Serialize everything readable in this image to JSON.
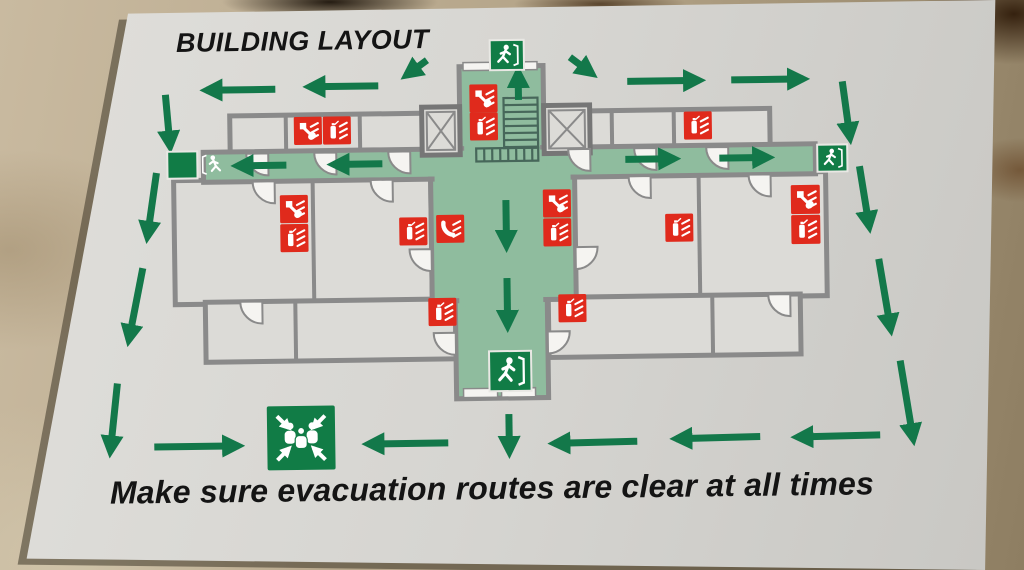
{
  "title": "BUILDING LAYOUT",
  "footer": "Make sure evacuation routes are clear at all times",
  "colors": {
    "floor": "#b4a489",
    "paper": "#d9d8d4",
    "wall": "#8a8a8a",
    "wall_dark": "#767676",
    "room": "#dcdbd7",
    "corridor": "#8fbc9e",
    "route_green": "#13784a",
    "sign_green": "#117c46",
    "alarm_red": "#e02a1c",
    "white": "#f5f4f1",
    "text": "#141414",
    "stairs": "#47675a"
  },
  "plan": {
    "rooms": [
      [
        232,
        112,
        196,
        38
      ],
      [
        550,
        112,
        222,
        38
      ],
      [
        175,
        176,
        257,
        124
      ],
      [
        575,
        176,
        252,
        124
      ],
      [
        205,
        298,
        250,
        60
      ],
      [
        548,
        298,
        252,
        60
      ]
    ],
    "inner_walls": [
      [
        288,
        112,
        288,
        150
      ],
      [
        362,
        112,
        362,
        150
      ],
      [
        614,
        112,
        614,
        150
      ],
      [
        676,
        112,
        676,
        150
      ],
      [
        314,
        176,
        314,
        300
      ],
      [
        700,
        176,
        700,
        300
      ],
      [
        295,
        298,
        295,
        358
      ],
      [
        712,
        298,
        712,
        358
      ]
    ],
    "corridors": [
      [
        462,
        66,
        84,
        112
      ],
      [
        205,
        148,
        612,
        30
      ],
      [
        432,
        178,
        144,
        122
      ],
      [
        455,
        300,
        92,
        98
      ]
    ],
    "patches": [
      [
        460,
        150,
        88,
        26
      ],
      [
        466,
        143,
        76,
        10
      ],
      [
        436,
        172,
        136,
        12
      ],
      [
        459,
        294,
        84,
        12
      ]
    ],
    "elevators": [
      [
        424,
        106,
        38,
        48
      ],
      [
        546,
        106,
        46,
        48
      ]
    ],
    "stairs": {
      "ladder": [
        506,
        98,
        34,
        50
      ],
      "run": [
        478,
        148,
        62,
        13
      ]
    },
    "doors": [
      [
        270,
        150,
        90
      ],
      [
        338,
        150,
        90
      ],
      [
        412,
        150,
        90
      ],
      [
        592,
        150,
        90
      ],
      [
        658,
        150,
        90
      ],
      [
        730,
        150,
        90
      ],
      [
        276,
        178,
        90
      ],
      [
        394,
        178,
        90
      ],
      [
        652,
        178,
        90
      ],
      [
        772,
        178,
        90
      ],
      [
        432,
        248,
        90
      ],
      [
        576,
        248,
        0
      ],
      [
        455,
        332,
        90
      ],
      [
        547,
        332,
        0
      ],
      [
        262,
        298,
        90
      ],
      [
        790,
        298,
        90
      ]
    ],
    "door_leafs": [
      [
        466,
        62,
        32,
        8
      ],
      [
        508,
        62,
        32,
        8
      ],
      [
        462,
        388,
        34,
        9
      ],
      [
        500,
        388,
        34,
        9
      ]
    ]
  },
  "corridor_arrows": [
    [
      521,
      100,
      521,
      72
    ],
    [
      288,
      162,
      239,
      162
    ],
    [
      384,
      162,
      335,
      162
    ],
    [
      627,
      161,
      676,
      161
    ],
    [
      721,
      161,
      770,
      161
    ],
    [
      507,
      200,
      507,
      246
    ],
    [
      507,
      278,
      507,
      326
    ]
  ],
  "route_arrows": [
    [
      430,
      59,
      409,
      74
    ],
    [
      381,
      84,
      312,
      84
    ],
    [
      278,
      86,
      209,
      86
    ],
    [
      573,
      58,
      595,
      75
    ],
    [
      630,
      83,
      702,
      83
    ],
    [
      734,
      83,
      806,
      83
    ],
    [
      168,
      90,
      172,
      142
    ],
    [
      158,
      168,
      148,
      232
    ],
    [
      143,
      263,
      128,
      335
    ],
    [
      116,
      378,
      108,
      446
    ],
    [
      845,
      86,
      852,
      143
    ],
    [
      861,
      171,
      870,
      232
    ],
    [
      879,
      264,
      890,
      335
    ],
    [
      899,
      366,
      911,
      445
    ],
    [
      878,
      440,
      795,
      441
    ],
    [
      758,
      440,
      674,
      441
    ],
    [
      635,
      443,
      552,
      444
    ],
    [
      507,
      414,
      507,
      452
    ],
    [
      446,
      442,
      366,
      442
    ],
    [
      152,
      442,
      236,
      442
    ]
  ],
  "safety_signs": [
    {
      "type": "call-point",
      "x": 472,
      "y": 84,
      "s": 28
    },
    {
      "type": "extinguisher",
      "x": 472,
      "y": 112,
      "s": 28
    },
    {
      "type": "call-point",
      "x": 296,
      "y": 114,
      "s": 28
    },
    {
      "type": "extinguisher",
      "x": 325,
      "y": 114,
      "s": 28
    },
    {
      "type": "extinguisher",
      "x": 686,
      "y": 114,
      "s": 28
    },
    {
      "type": "call-point",
      "x": 281,
      "y": 192,
      "s": 28
    },
    {
      "type": "extinguisher",
      "x": 281,
      "y": 221,
      "s": 28
    },
    {
      "type": "extinguisher",
      "x": 400,
      "y": 216,
      "s": 28
    },
    {
      "type": "fire-telephone",
      "x": 437,
      "y": 214,
      "s": 28
    },
    {
      "type": "call-point",
      "x": 544,
      "y": 190,
      "s": 28
    },
    {
      "type": "extinguisher",
      "x": 544,
      "y": 219,
      "s": 28
    },
    {
      "type": "extinguisher",
      "x": 666,
      "y": 216,
      "s": 28
    },
    {
      "type": "call-point",
      "x": 792,
      "y": 189,
      "s": 29
    },
    {
      "type": "extinguisher",
      "x": 792,
      "y": 219,
      "s": 29
    },
    {
      "type": "extinguisher",
      "x": 428,
      "y": 297,
      "s": 28
    },
    {
      "type": "extinguisher",
      "x": 558,
      "y": 295,
      "s": 28
    }
  ],
  "exit_signs": [
    {
      "x": 493,
      "y": 40,
      "w": 34,
      "h": 30,
      "dir": "right",
      "location": "top"
    },
    {
      "x": 169,
      "y": 147,
      "w": 30,
      "h": 27,
      "dir": "left",
      "location": "left"
    },
    {
      "x": 819,
      "y": 149,
      "w": 30,
      "h": 27,
      "dir": "right",
      "location": "right"
    },
    {
      "x": 488,
      "y": 351,
      "w": 42,
      "h": 40,
      "dir": "right",
      "location": "bottom"
    }
  ],
  "assembly_point": {
    "x": 265,
    "y": 403,
    "w": 68,
    "h": 64
  },
  "icon_legend": {
    "call-point": "fire-alarm-call-point-sign",
    "extinguisher": "fire-extinguisher-sign",
    "fire-telephone": "fire-telephone-sign",
    "exit": "emergency-exit-running-man-sign",
    "assembly": "assembly-point-sign"
  }
}
